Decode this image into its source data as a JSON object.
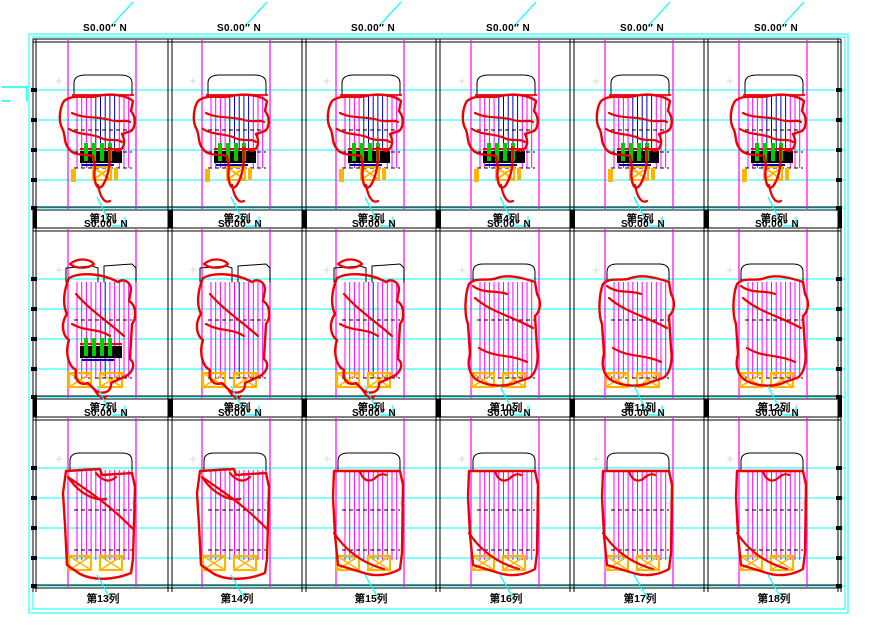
{
  "sheet": {
    "width": 870,
    "height": 635
  },
  "title": "S0.00″ N",
  "colors": {
    "red": "#ee0000",
    "magenta": "#ff00ff",
    "cyan": "#00ffff",
    "blue": "#0000bb",
    "green": "#00cc00",
    "orange": "#ffb400",
    "black": "#000000",
    "gray_mark": "#d9d9d9",
    "white": "#ffffff"
  },
  "rows": [
    {
      "panels": [
        {
          "label": "第1列",
          "style": "A",
          "cap": "arch",
          "green": true
        },
        {
          "label": "第2列",
          "style": "A",
          "cap": "arch",
          "green": true
        },
        {
          "label": "第3列",
          "style": "A",
          "cap": "arch",
          "green": true
        },
        {
          "label": "第4列",
          "style": "A",
          "cap": "arch",
          "green": true
        },
        {
          "label": "第5列",
          "style": "A",
          "cap": "arch",
          "green": true
        },
        {
          "label": "第6列",
          "style": "A",
          "cap": "arch",
          "green": true
        }
      ]
    },
    {
      "panels": [
        {
          "label": "第7列",
          "style": "B1",
          "cap": "split",
          "green": true
        },
        {
          "label": "第8列",
          "style": "B1",
          "cap": "split",
          "green": false
        },
        {
          "label": "第9列",
          "style": "B1",
          "cap": "split",
          "green": false
        },
        {
          "label": "第10列",
          "style": "B2",
          "cap": "arch2",
          "green": false
        },
        {
          "label": "第11列",
          "style": "B2",
          "cap": "arch2",
          "green": false
        },
        {
          "label": "第12列",
          "style": "B2",
          "cap": "arch2",
          "green": false
        }
      ]
    },
    {
      "panels": [
        {
          "label": "第13列",
          "style": "C1",
          "cap": "arch2",
          "green": false
        },
        {
          "label": "第14列",
          "style": "C1",
          "cap": "arch2",
          "green": false
        },
        {
          "label": "第15列",
          "style": "C2",
          "cap": "arch2",
          "green": false
        },
        {
          "label": "第16列",
          "style": "C2",
          "cap": "arch2",
          "green": false
        },
        {
          "label": "第17列",
          "style": "C2",
          "cap": "arch2",
          "green": false
        },
        {
          "label": "第18列",
          "style": "C2",
          "cap": "arch2",
          "green": false
        }
      ]
    }
  ],
  "styles": {
    "A": {
      "outer": "M28,62 C38,54 52,60 62,57 C74,54 90,56 97,62 L95,72 C100,78 100,88 95,92 L86,95 C90,103 88,110 82,112 L73,109 C75,122 73,136 67,146 C61,154 57,142 59,128 L57,117 C48,115 38,117 33,110 C27,103 30,95 26,89 C22,81 24,68 28,62 Z",
      "inner": "M33,90 C44,97 56,94 65,99 C73,103 81,99 86,103 M36,74 C48,80 62,77 74,81 C84,84 90,80 94,83 M62,146 C64,157 68,165 74,162"
    },
    "B1": {
      "outer": "M33,50 C28,62 26,76 31,86 C24,96 27,108 33,112 C29,124 32,138 40,142 C38,152 44,158 52,155 L58,161 C66,168 76,164 75,155 L88,149 C97,145 100,136 94,131 L96,96 C102,88 99,76 93,73 L95,62 C95,54 88,50 82,54 C66,45 44,44 33,50 Z",
      "inner": "M40,66 C54,82 70,92 88,108 M36,96 C50,104 62,100 74,108 M58,161 C62,168 66,172 71,168"
    },
    "B2": {
      "outer": "M30,56 C38,48 50,54 58,50 C70,46 84,50 96,54 L98,66 C103,74 101,84 96,88 L98,120 C100,134 97,146 90,150 L78,154 C66,160 48,158 38,152 C30,147 28,136 31,126 L29,96 C25,86 26,66 30,56 Z",
      "inner": "M36,70 C52,84 72,88 94,100 M40,120 C56,130 72,126 88,134 M34,58 C44,66 58,62 68,66"
    },
    "C1": {
      "outer": "M30,54 L64,52 L66,58 L96,56 L99,70 L97,142 L95,156 C78,163 58,164 44,157 L31,148 L29,108 L27,76 Z",
      "inner": "M32,60 C52,74 74,88 97,112 M32,60 C44,78 60,84 70,82 M60,56 C66,64 74,66 80,60"
    },
    "C2": {
      "outer": "M30,54 L96,54 L99,68 L98,136 L96,152 C86,158 72,160 60,156 L34,148 L31,118 L29,80 Z",
      "inner": "M56,54 C58,62 64,66 70,62 C74,58 78,56 82,58 M30,116 C42,134 58,146 80,152"
    }
  }
}
